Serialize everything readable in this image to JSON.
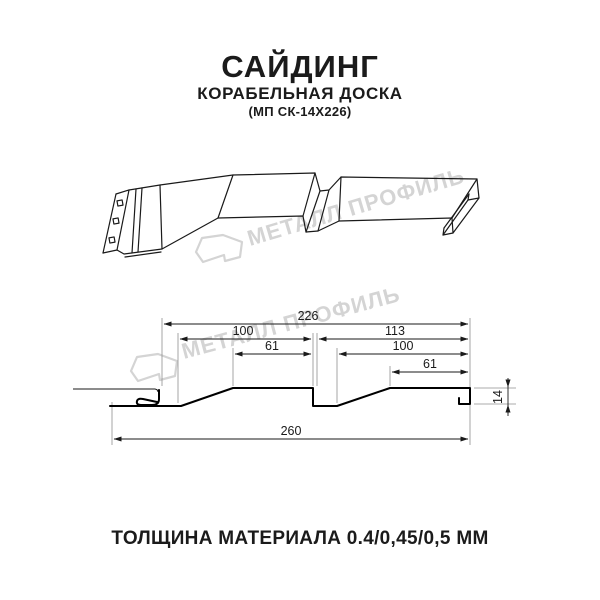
{
  "header": {
    "title": "САЙДИНГ",
    "subtitle": "КОРАБЕЛЬНАЯ ДОСКА",
    "product_code": "(МП СК-14Х226)"
  },
  "watermark": {
    "brand_text": "МЕТАЛЛ ПРОФИЛЬ",
    "color": "#d4d4d4"
  },
  "cross_section": {
    "dims": {
      "total_width": "226",
      "left_pitch": "100",
      "left_flat": "61",
      "right_segment": "113",
      "right_pitch": "100",
      "right_flat": "61",
      "overall_width": "260",
      "profile_height": "14"
    }
  },
  "footer": {
    "thickness_note": "ТОЛЩИНА МАТЕРИАЛА 0.4/0,45/0,5 ММ"
  }
}
